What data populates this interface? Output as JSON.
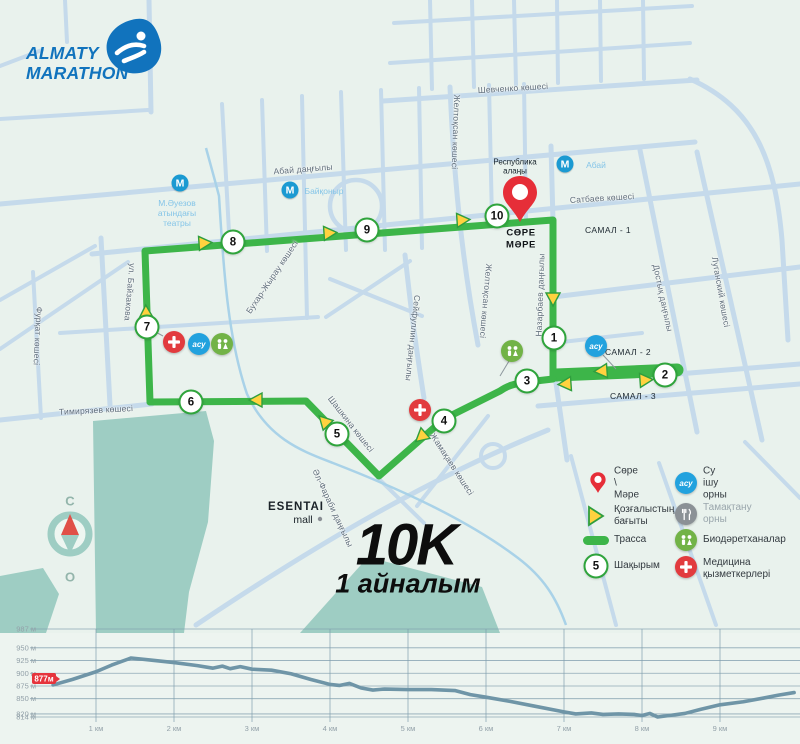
{
  "logo": {
    "line1": "ALMATY",
    "line2": "MARATHON"
  },
  "course": {
    "distance": "10K",
    "laps": "1 айналым"
  },
  "start_finish": {
    "line1": "СӨРЕ",
    "line2": "МӘРЕ"
  },
  "compass": {
    "north": "С",
    "south": "О"
  },
  "water_icon_text": "асу",
  "metro_letter": "М",
  "places": {
    "republic_square_line1": "Республика",
    "republic_square_line2": "алаңы",
    "theater_line1": "М.Әуезов",
    "theater_line2": "атындағы",
    "theater_line3": "театры",
    "metro_abai": "Абай",
    "metro_baikonur": "Байқоныр",
    "esentai": "ESENTAI",
    "esentai_sub": "mall",
    "samal1": "САМАЛ - 1",
    "samal2": "САМАЛ - 2",
    "samal3": "САМАЛ - 3"
  },
  "streets": [
    {
      "name": "Шевченко көшесі"
    },
    {
      "name": "Абай даңғылы"
    },
    {
      "name": "Сатбаев көшесі"
    },
    {
      "name": "Желтоқсан көшесі"
    },
    {
      "name": "Желтоқсан көшесі"
    },
    {
      "name": "Назарбаев даңғылы"
    },
    {
      "name": "Достық даңғылы"
    },
    {
      "name": "Луганский көшесі"
    },
    {
      "name": "Фурқат көшесі"
    },
    {
      "name": "ул. Байзакова"
    },
    {
      "name": "Бухар-Жырау көшесі"
    },
    {
      "name": "Тимирязев көшесі"
    },
    {
      "name": "Сейфуллин даңғылы"
    },
    {
      "name": "Шашкина көшесі"
    },
    {
      "name": "Жамақаев көшесі"
    },
    {
      "name": "Әл-Фараби даңғылы"
    }
  ],
  "km_markers": [
    "1",
    "2",
    "3",
    "4",
    "5",
    "6",
    "7",
    "8",
    "9",
    "10"
  ],
  "legend": {
    "start_finish": "Сөре \\ Мәре",
    "direction": "Қозғалыстың бағыты",
    "course": "Трасса",
    "km": "Шақырым",
    "km_badge": "5",
    "water": "Су ішу орны",
    "food": "Тамақтану орны",
    "toilets": "Биодәретханалар",
    "medical": "Медицина қызметкерлері"
  },
  "chart_data": {
    "type": "line",
    "title": "",
    "xlabel": "дистанция (км)",
    "ylabel": "биіктік (м)",
    "ylim": [
      814,
      987
    ],
    "xlim": [
      0,
      10.05
    ],
    "grid": true,
    "start_label": "877м",
    "y_values": [
      987,
      950,
      925,
      900,
      875,
      850,
      820,
      814
    ],
    "y_ticks": [
      "987 м",
      "950 м",
      "925 м",
      "900 м",
      "875 м",
      "850 м",
      "820 м",
      "814 м"
    ],
    "x_values": [
      1,
      2,
      3,
      4,
      5,
      6,
      7,
      8,
      9
    ],
    "x_ticks": [
      "1 км",
      "2 км",
      "3 км",
      "4 км",
      "5 км",
      "6 км",
      "7 км",
      "8 км",
      "9 км"
    ],
    "series": [
      {
        "name": "elevation",
        "x": [
          0.45,
          0.7,
          1.0,
          1.2,
          1.45,
          1.7,
          2.0,
          2.3,
          2.5,
          2.62,
          2.72,
          2.85,
          3.0,
          3.25,
          3.5,
          3.75,
          4.0,
          4.12,
          4.25,
          4.4,
          4.55,
          4.7,
          5.0,
          5.3,
          5.6,
          5.8,
          6.0,
          6.3,
          6.6,
          7.0,
          7.15,
          7.35,
          7.5,
          7.7,
          7.9,
          8.0,
          8.1,
          8.2,
          8.35,
          8.55,
          8.75,
          9.0,
          9.3,
          9.55,
          9.75,
          9.95
        ],
        "y": [
          877,
          888,
          903,
          916,
          930,
          926,
          921,
          915,
          910,
          914,
          909,
          913,
          908,
          906,
          899,
          888,
          878,
          876,
          880,
          871,
          867,
          869,
          868,
          868,
          866,
          858,
          853,
          845,
          836,
          824,
          820,
          822,
          819,
          820,
          819,
          817,
          821,
          814,
          817,
          821,
          829,
          838,
          844,
          851,
          857,
          862
        ]
      }
    ]
  }
}
